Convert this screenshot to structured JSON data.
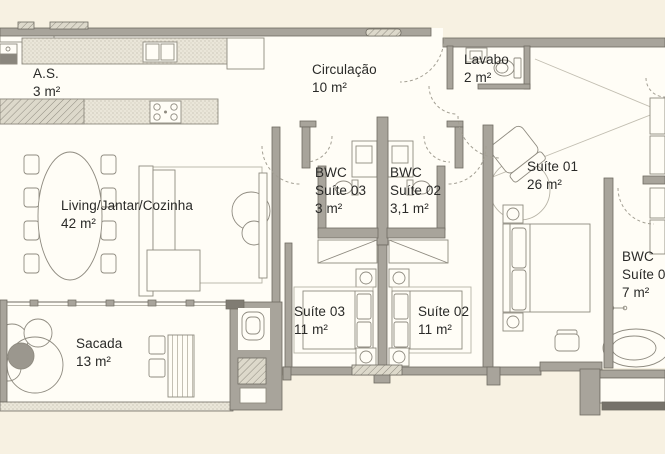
{
  "palette": {
    "background": "#f7f1e2",
    "paper": "#fffdf6",
    "wall": "#a8a49b",
    "wall_dark": "#6f6b62",
    "furniture_line": "#8f8b80",
    "text": "#2a2a28"
  },
  "rooms": [
    {
      "id": "as",
      "l1": "A.S.",
      "area": "3 m²"
    },
    {
      "id": "living",
      "l1": "Living/Jantar/Cozinha",
      "area": "42 m²"
    },
    {
      "id": "circulacao",
      "l1": "Circulação",
      "area": "10 m²"
    },
    {
      "id": "lavabo",
      "l1": "Lavabo",
      "area": "2 m²"
    },
    {
      "id": "bwc-suite03",
      "l1": "BWC",
      "l2": "Suíte 03",
      "area": "3 m²"
    },
    {
      "id": "bwc-suite02",
      "l1": "BWC",
      "l2": "Suíte 02",
      "area": "3,1 m²"
    },
    {
      "id": "suite01",
      "l1": "Suíte 01",
      "area": "26 m²"
    },
    {
      "id": "suite03",
      "l1": "Suíte 03",
      "area": "11 m²"
    },
    {
      "id": "suite02",
      "l1": "Suíte 02",
      "area": "11 m²"
    },
    {
      "id": "bwc-suite01",
      "l1": "BWC",
      "l2": "Suíte 01",
      "area": "7 m²"
    },
    {
      "id": "sacada",
      "l1": "Sacada",
      "area": "13 m²"
    }
  ]
}
